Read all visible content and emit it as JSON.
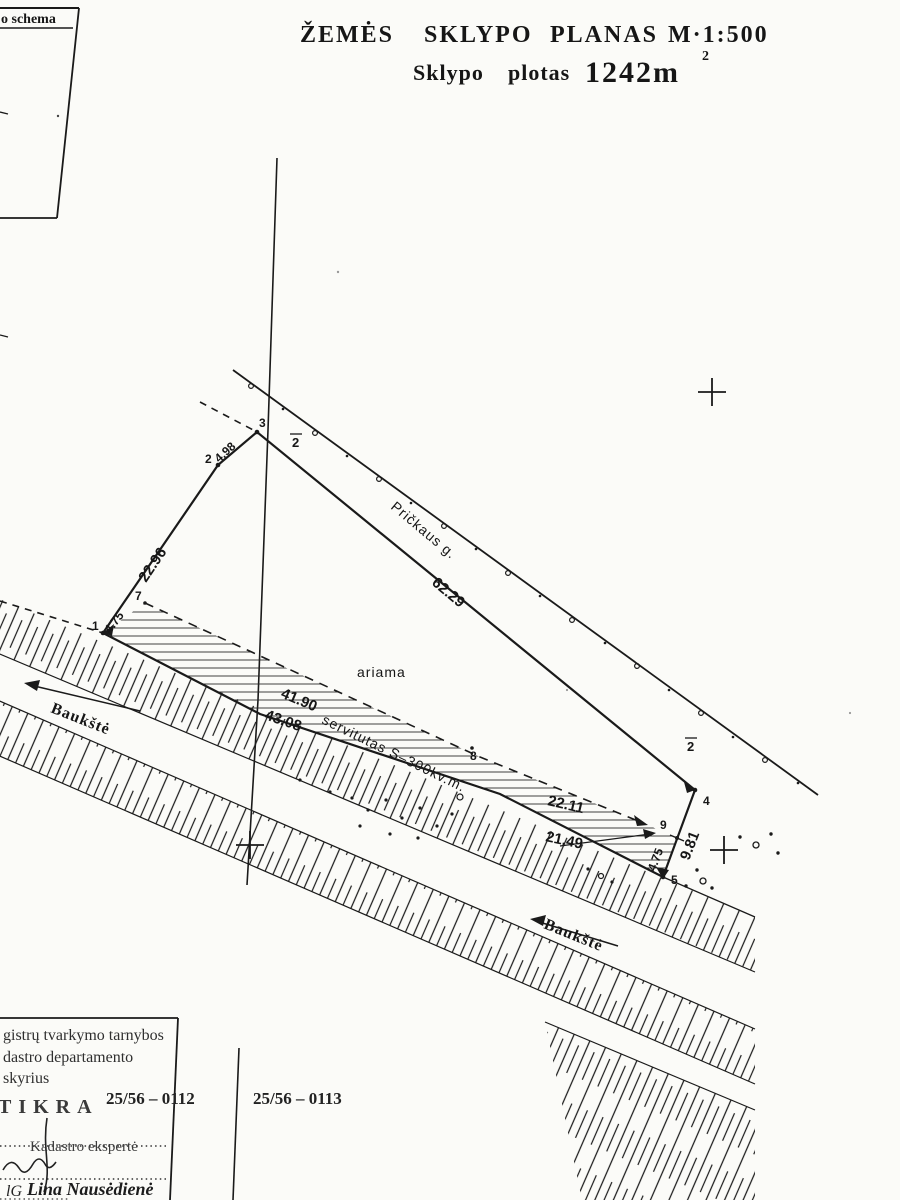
{
  "title": {
    "words": [
      "ŽEMĖS",
      "SKLYPO",
      "PLANAS",
      "M·1:500"
    ],
    "area_label_1": "Sklypo",
    "area_label_2": "plotas",
    "area_value": "1242m",
    "area_exp": "2"
  },
  "schema": {
    "label": "o schema"
  },
  "plan": {
    "street": "Pričkaus g.",
    "landuse": "ariama",
    "servitude": "servitutas S–300kv.m.",
    "stream1": "Baukštė",
    "stream2": "Baukštė",
    "road_no": "2",
    "dims": {
      "d12": "22.96",
      "d23": "4.98",
      "d34": "62.29",
      "d49": "9.81",
      "d95": "4.75",
      "d17": "4.75",
      "seg1": "43.08",
      "seg2": "21.49",
      "dash1": "41.90",
      "dash2": "22.11"
    },
    "pts": {
      "p1": "1",
      "p2": "2",
      "p3": "3",
      "p4": "4",
      "p5": "5",
      "p7": "7",
      "p8": "8",
      "p9": "9"
    }
  },
  "footer": {
    "stamp": [
      "gistrų tvarkymo tarnybos",
      "dastro departamento",
      "skyrius"
    ],
    "tikra": "TIKRA",
    "code1": "25/56 – 0112",
    "code2": "25/56 – 0113",
    "role": "Kadastro ekspertė",
    "sig_initials": "lG",
    "name": "Lina Nausėdienė"
  }
}
